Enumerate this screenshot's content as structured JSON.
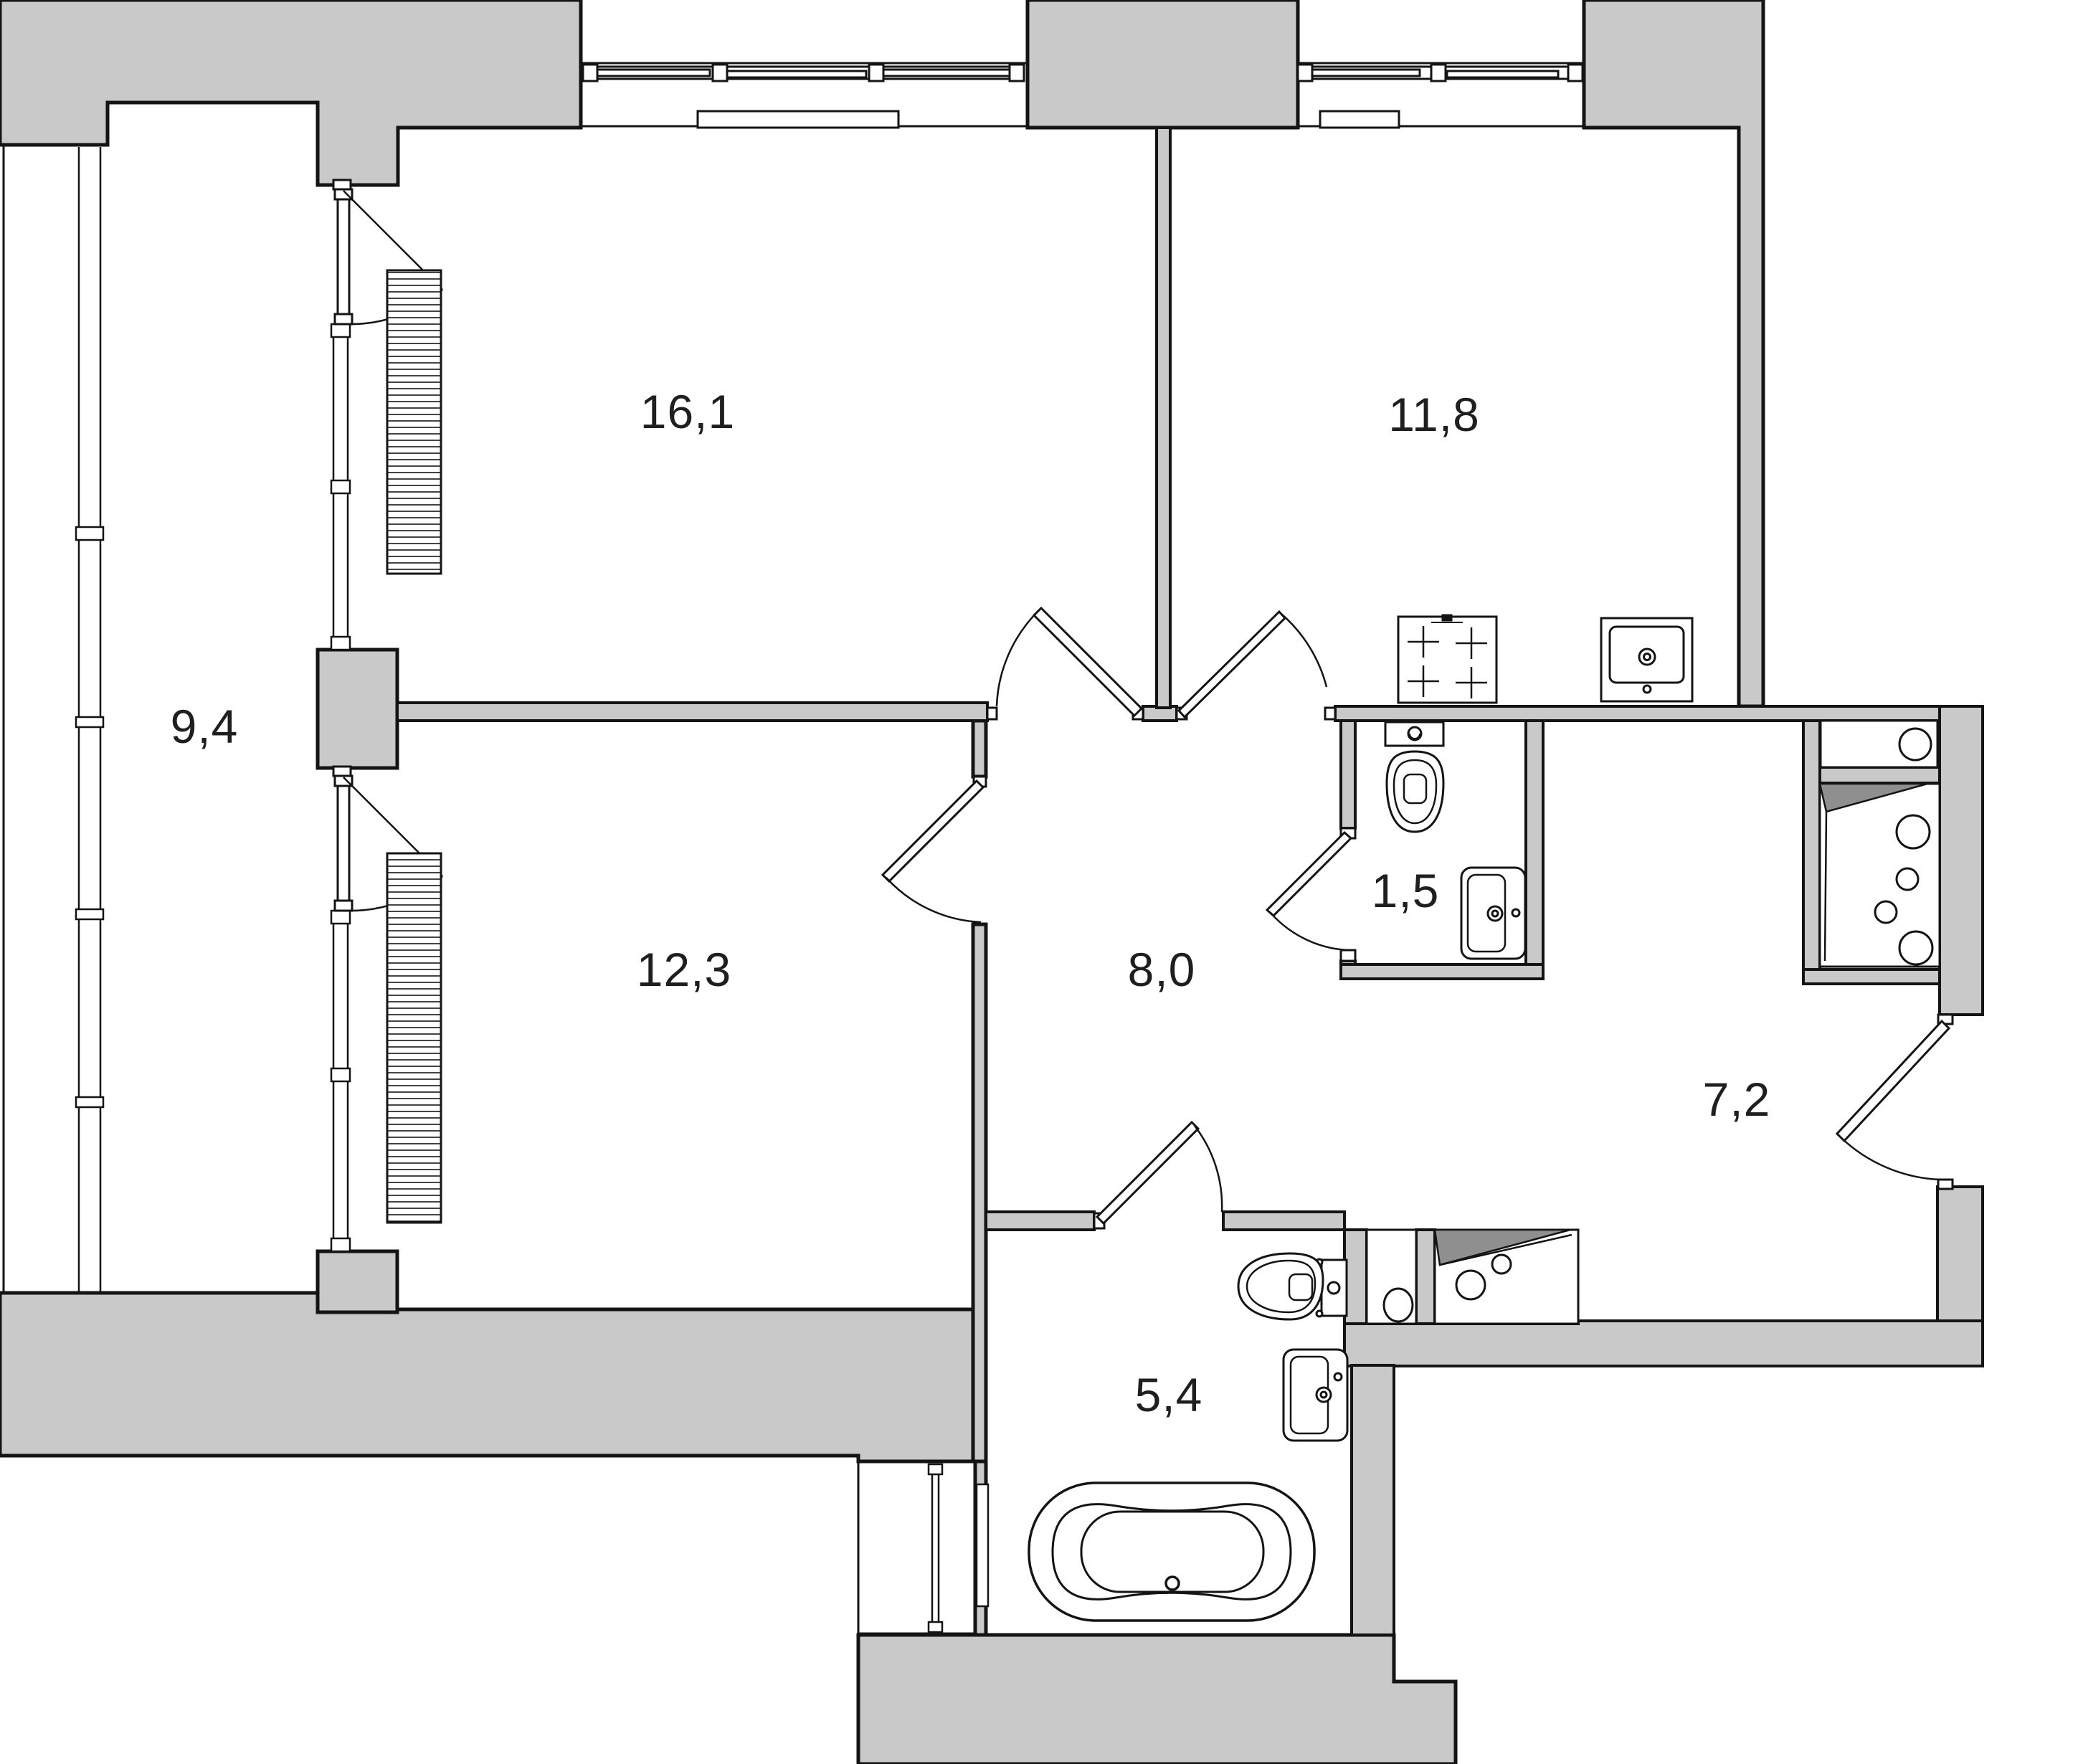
{
  "title": "Apartment floor plan (2-room layout)",
  "units": "m2",
  "colors": {
    "wall_fill": "#c9c9c9",
    "line": "#141414",
    "shade": "#8f8f8f",
    "background": "#ffffff",
    "label": "#1f1f1f"
  },
  "rooms": [
    {
      "name": "living-room",
      "area_label": "16,1"
    },
    {
      "name": "kitchen",
      "area_label": "11,8"
    },
    {
      "name": "balcony",
      "area_label": "9,4"
    },
    {
      "name": "bedroom",
      "area_label": "12,3"
    },
    {
      "name": "hallway",
      "area_label": "8,0"
    },
    {
      "name": "wc",
      "area_label": "1,5"
    },
    {
      "name": "corridor",
      "area_label": "7,2"
    },
    {
      "name": "bathroom",
      "area_label": "5,4"
    }
  ],
  "fixtures": [
    "wardrobe-living-room",
    "wardrobe-bedroom",
    "radiator-living-room",
    "radiator-kitchen",
    "stove",
    "kitchen-sink",
    "wc-toilet",
    "wc-sink",
    "bathroom-toilet",
    "bathroom-sink",
    "bathtub",
    "towel-rail",
    "laundry-niche-sink",
    "laundry-niche-washer",
    "utility-counter-sink",
    "utility-washer",
    "shaft-door",
    "entrance-door"
  ]
}
